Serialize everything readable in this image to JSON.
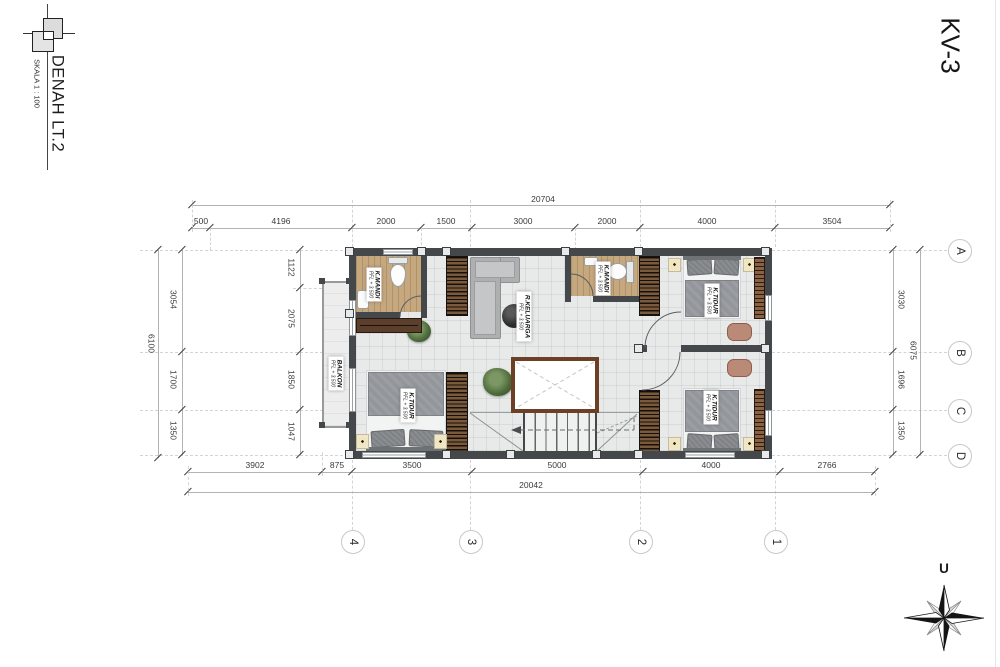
{
  "sheet": {
    "title": "DENAH LT.2",
    "scale_label": "SKALA 1 : 100",
    "sheet_code": "KV-3",
    "north_label": "U"
  },
  "grid": {
    "row_labels": [
      "A",
      "B",
      "C",
      "D"
    ],
    "col_labels": [
      "4",
      "3",
      "2",
      "1"
    ]
  },
  "dimensions": {
    "top_total": "20704",
    "top_segments": [
      "500",
      "4196",
      "2000",
      "1500",
      "3000",
      "2000",
      "4000",
      "3504"
    ],
    "bottom_segments": [
      "3902",
      "875",
      "3500",
      "5000",
      "4000",
      "2766"
    ],
    "bottom_total": "20042",
    "left_total": "6100",
    "left_segments": [
      "3054",
      "1700",
      "1350"
    ],
    "left_inner_segments": [
      "1122",
      "2075",
      "1850",
      "1047"
    ],
    "right_total": "6075",
    "right_segments": [
      "3030",
      "1696",
      "1350"
    ]
  },
  "rooms": {
    "bath_left": {
      "name": "K.MANDI",
      "level": "PFL + 3.500"
    },
    "bath_mid": {
      "name": "K.MANDI",
      "level": "PFL + 3.500"
    },
    "family_room": {
      "name": "R.KELUARGA",
      "level": "PFL + 3.500"
    },
    "balcony": {
      "name": "BALKON",
      "level": "PFL + 3.500"
    },
    "bedroom_left": {
      "name": "K.TIDUR",
      "level": "PFL + 3.500"
    },
    "bedroom_top_right": {
      "name": "K.TIDUR",
      "level": "PFL + 3.500"
    },
    "bedroom_bot_right": {
      "name": "K.TIDUR",
      "level": "PFL + 3.500"
    }
  },
  "colors": {
    "wall": "#45484b",
    "wood_floor": "#c6a87f",
    "accent_brown": "#6b4026",
    "floor": "#e8e9e9"
  }
}
